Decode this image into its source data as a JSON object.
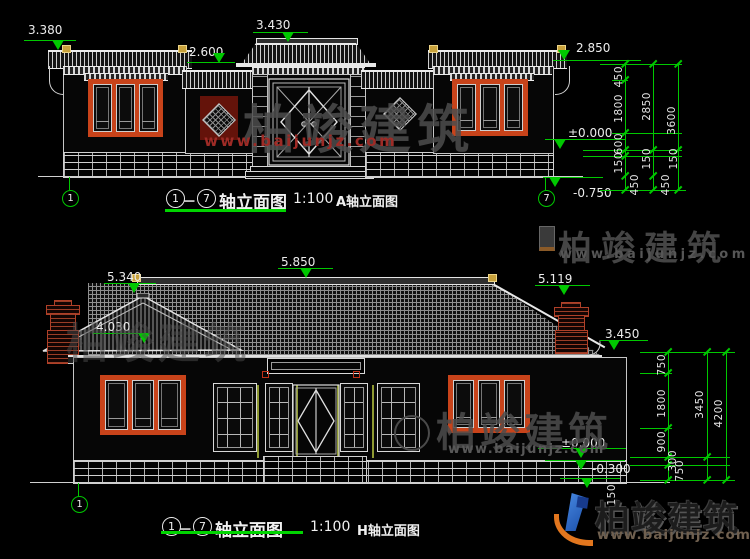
{
  "meta": {
    "brand": "柏竣建筑",
    "url": "www.baijunjz.com"
  },
  "elevA": {
    "caption": {
      "from": "1",
      "dash": "－",
      "to": "7",
      "title": "轴立面图",
      "scale": "1:100",
      "name": "A轴立面图"
    },
    "axis": {
      "left": "1",
      "right": "7"
    },
    "levels": {
      "roof_left": "3.380",
      "gate_top": "3.430",
      "side_left": "2.600",
      "eave_right": "2.850",
      "zero": "±0.000",
      "ground": "-0.750"
    },
    "dims": {
      "t450": "450",
      "t1800": "1800",
      "t600": "600",
      "t150": "150",
      "b450": "450",
      "m2850": "2850",
      "m150": "150",
      "mb450": "450",
      "o3600": "3600",
      "o150": "150"
    }
  },
  "elevH": {
    "caption": {
      "from": "1",
      "dash": "－",
      "to": "7",
      "title": "轴立面图",
      "scale": "1:100",
      "name": "H轴立面图"
    },
    "axis": {
      "left": "1"
    },
    "levels": {
      "ridge": "5.850",
      "gable": "5.340",
      "chimney": "5.119",
      "slope": "4.030",
      "eave": "3.450",
      "zero": "±0.000",
      "ground": "-0.300"
    },
    "dims": {
      "t750": "750",
      "t1800": "1800",
      "t900": "900",
      "t300": "300",
      "b750": "750",
      "b150": "150",
      "m3450": "3450",
      "o4200": "4200"
    }
  }
}
